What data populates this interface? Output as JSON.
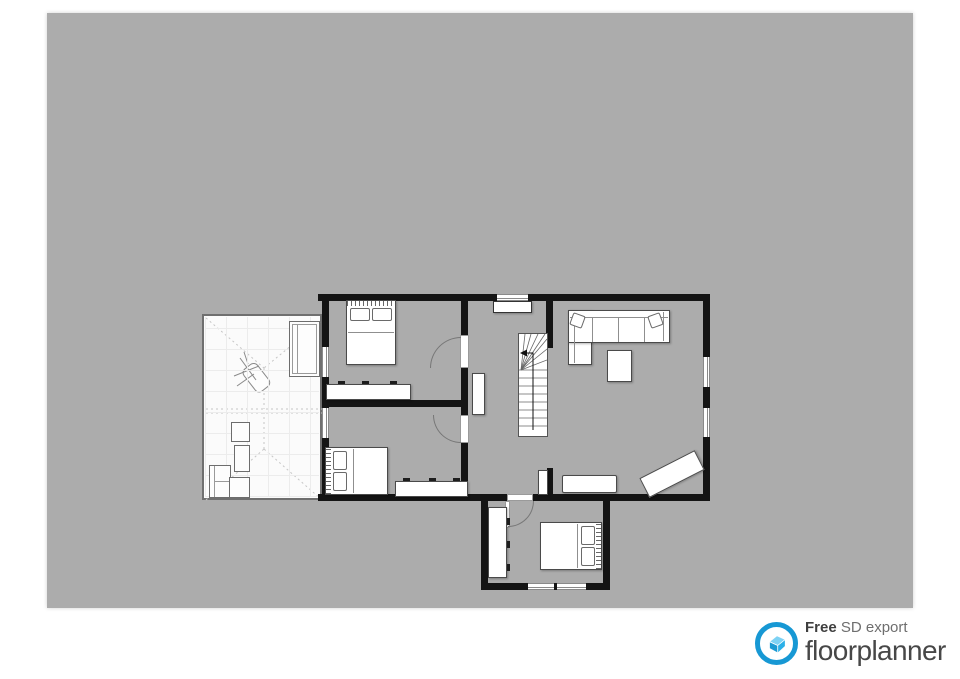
{
  "page": {
    "background": "#ffffff"
  },
  "canvas": {
    "background": "#acacac",
    "width": 866,
    "height": 595
  },
  "palette": {
    "wall": "#141414",
    "furniture_fill": "#ffffff",
    "furniture_stroke": "#4a4a4a",
    "white_room_floor": "#fbfbfb",
    "dashed_line": "#c9c9c9",
    "window_frame": "#8a8a8a",
    "door_arc": "#777777"
  },
  "branding": {
    "free_label": "Free",
    "export_label": " SD export",
    "brand_name": "floorplanner",
    "ring_color": "#1798d4",
    "house_light": "#7dd2f4",
    "house_mid": "#2ab0e8",
    "house_dark": "#1b9ad2"
  },
  "floorplan": {
    "rooms": [
      {
        "name": "attic-terrace",
        "floor": "white",
        "furniture": [
          "sideboard",
          "lounge-chair-sketch",
          "two-seat-sofa",
          "side-table",
          "armchair",
          "side-table"
        ]
      },
      {
        "name": "bedroom-top",
        "floor": "gray",
        "furniture": [
          "double-bed",
          "dresser"
        ],
        "openings": [
          "door-to-hallway",
          "window-left"
        ]
      },
      {
        "name": "bedroom-bottom",
        "floor": "gray",
        "furniture": [
          "double-bed",
          "dresser"
        ],
        "openings": [
          "door-to-hallway",
          "window-left"
        ]
      },
      {
        "name": "hallway",
        "floor": "gray",
        "furniture": [
          "staircase",
          "sideboard-under-window",
          "wall-cabinet",
          "small-cabinet"
        ],
        "openings": [
          "window-top"
        ]
      },
      {
        "name": "living-room",
        "floor": "gray",
        "furniture": [
          "corner-sofa",
          "throw-pillows",
          "coffee-table",
          "sideboard",
          "rotated-bench"
        ],
        "openings": [
          "window-right-upper",
          "window-right-lower"
        ]
      },
      {
        "name": "bedroom-annex",
        "floor": "gray",
        "furniture": [
          "double-bed",
          "wardrobe"
        ],
        "openings": [
          "door-to-hallway",
          "window-bottom-left",
          "window-bottom-right"
        ]
      }
    ]
  }
}
